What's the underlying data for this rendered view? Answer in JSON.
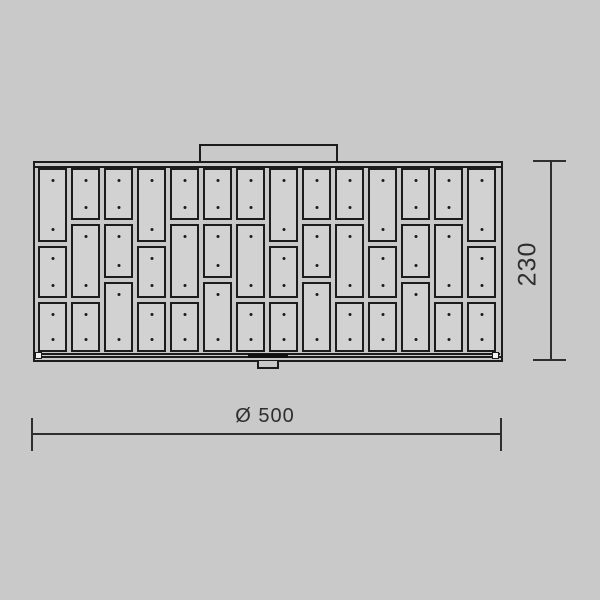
{
  "drawing": {
    "type": "technical-dimension-drawing",
    "subject": "rectangular ceiling lamp, front view, staggered plate shade",
    "dimensions": {
      "width_label": "Ø 500",
      "height_label": "230"
    },
    "colors": {
      "background": "#c9c9c9",
      "panel_fill": "#d2d2d2",
      "outline": "#1c1c1c",
      "dimension": "#2e2e2e"
    },
    "panel_grid": {
      "columns": 14,
      "panels_per_column": 3,
      "dots_per_panel": 2,
      "column_types": [
        "A",
        "C",
        "B",
        "A",
        "C",
        "B",
        "C",
        "A",
        "B",
        "C",
        "A",
        "B",
        "C",
        "A"
      ],
      "type_split_fractions": {
        "A": [
          0.402,
          0.707
        ],
        "B": [
          0.283,
          0.598
        ],
        "C": [
          0.283,
          0.707
        ]
      },
      "column_gap_px": 4,
      "row_gap_px": 4
    }
  }
}
